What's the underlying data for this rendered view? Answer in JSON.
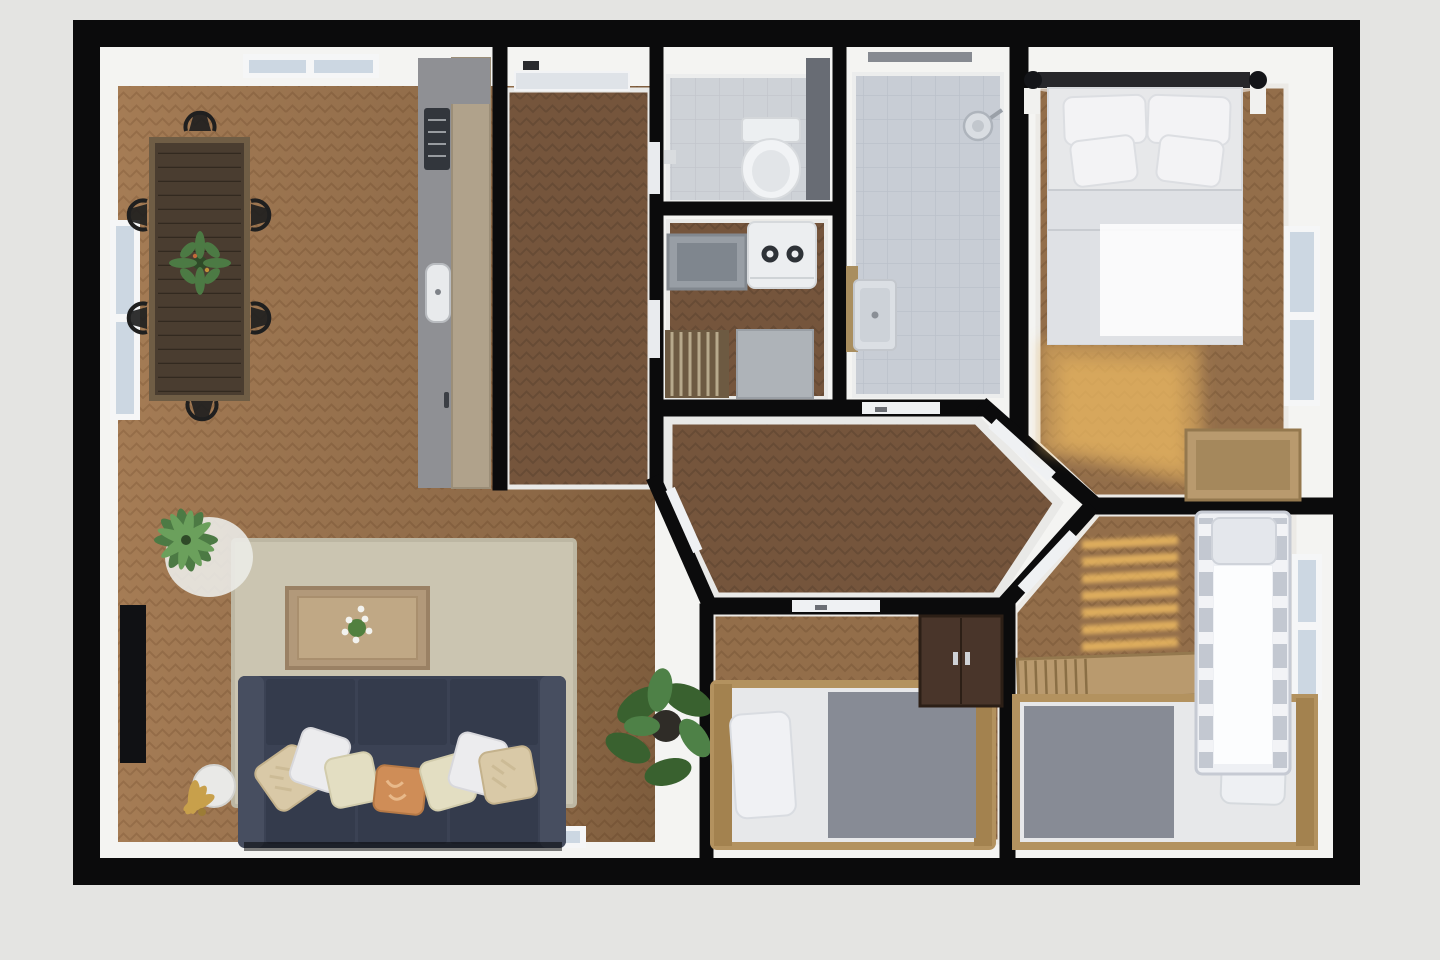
{
  "scene": {
    "kind": "3d-floor-plan-top-view",
    "background": "#e4e4e2",
    "no_visible_text": true
  },
  "colors": {
    "bg": "#e4e4e2",
    "wall": "#0b0b0c",
    "wallFace": "#f4f4f2",
    "floorLight": "#a57c55",
    "floorLightLine": "#8a6340",
    "floorDark": "#75553c",
    "floorDarkLine": "#5d4430",
    "floorMid": "#936e4a",
    "floorMidLine": "#7a5839",
    "tile": "#ced2d7",
    "tileLine": "#bfc3c9",
    "bathTile": "#c8cdd5",
    "bathTileLine": "#b8bdc7",
    "rug": "#cbc5b1",
    "sofa": "#3b4254",
    "sofaDark": "#343b4c",
    "sofaArm": "#474e60",
    "pillowWhite": "#ececee",
    "pillowCream": "#e3dec2",
    "pillowBeige": "#d9c9a7",
    "pillowOrange": "#cf8d57",
    "woodTableTop": "#4a3d30",
    "woodTableEdge": "#6f5d45",
    "coffeeTable": "#b2997a",
    "woodFrame": "#b3925f",
    "woodFrameDark": "#a3824f",
    "counter": "#8f9094",
    "cabinet": "#b0a28b",
    "bedWhite": "#e7e8ea",
    "duvet": "#dfe1e5",
    "blanketGray": "#878b95",
    "wardrobe": "#49352a",
    "window": "#ccd7e2",
    "windowFrame": "#f5f6f7",
    "sun": "#f2bd63",
    "plant": "#4c7a44",
    "plantDark": "#39612f",
    "gold": "#c8a04b",
    "tv": "#101114",
    "applianceWhite": "#eceef0",
    "grayCrate": "#989ea5",
    "grayBox": "#aeb3b8"
  },
  "rooms": [
    {
      "id": "living-dining-room",
      "floor": "light-herringbone",
      "furniture": [
        "dining-table",
        "dining-chairs-x6",
        "table-centerpiece-plant",
        "kitchen-counter",
        "stove",
        "kitchen-sink",
        "tall-cabinet",
        "area-rug",
        "coffee-table",
        "flower-bouquet",
        "sofa-3-seat",
        "throw-pillows-x7",
        "palm-plant",
        "monstera-plant",
        "floor-lamp-gold",
        "side-table-round",
        "wall-tv"
      ],
      "windows": [
        "left-wall-window",
        "top-skylight",
        "bottom-window-1",
        "bottom-window-2"
      ]
    },
    {
      "id": "entry-hall",
      "floor": "dark-herringbone",
      "furniture": [
        "front-door"
      ]
    },
    {
      "id": "wc",
      "floor": "gray-tile",
      "furniture": [
        "toilet",
        "cistern",
        "paper-holder",
        "wall-cabinet"
      ]
    },
    {
      "id": "laundry-room",
      "floor": "dark-herringbone",
      "furniture": [
        "washing-machine",
        "laundry-crate",
        "drying-rack",
        "storage-box"
      ]
    },
    {
      "id": "bathroom",
      "floor": "blue-gray-tile",
      "furniture": [
        "shower-head",
        "ceiling-vent",
        "vanity-sink"
      ]
    },
    {
      "id": "master-bedroom",
      "floor": "mid-herringbone",
      "furniture": [
        "double-bed",
        "headboard",
        "pillows-x4",
        "wall-lamps-x2",
        "nightstands-x2",
        "storage-bench"
      ],
      "windows": [
        "right-wall-window"
      ],
      "lighting": [
        "sun-patch"
      ]
    },
    {
      "id": "hallway-hexagonal",
      "floor": "dark-herringbone",
      "furniture": [
        "door-leaves-x5"
      ]
    },
    {
      "id": "small-bedroom",
      "floor": "mid-herringbone",
      "furniture": [
        "single-bed",
        "pillow",
        "wardrobe"
      ],
      "windows": [
        "bottom-window"
      ]
    },
    {
      "id": "kids-bedroom",
      "floor": "mid-herringbone",
      "furniture": [
        "single-bed",
        "pillow",
        "crib",
        "wooden-bench"
      ],
      "windows": [
        "right-wall-window"
      ],
      "lighting": [
        "sun-stripes"
      ]
    }
  ]
}
